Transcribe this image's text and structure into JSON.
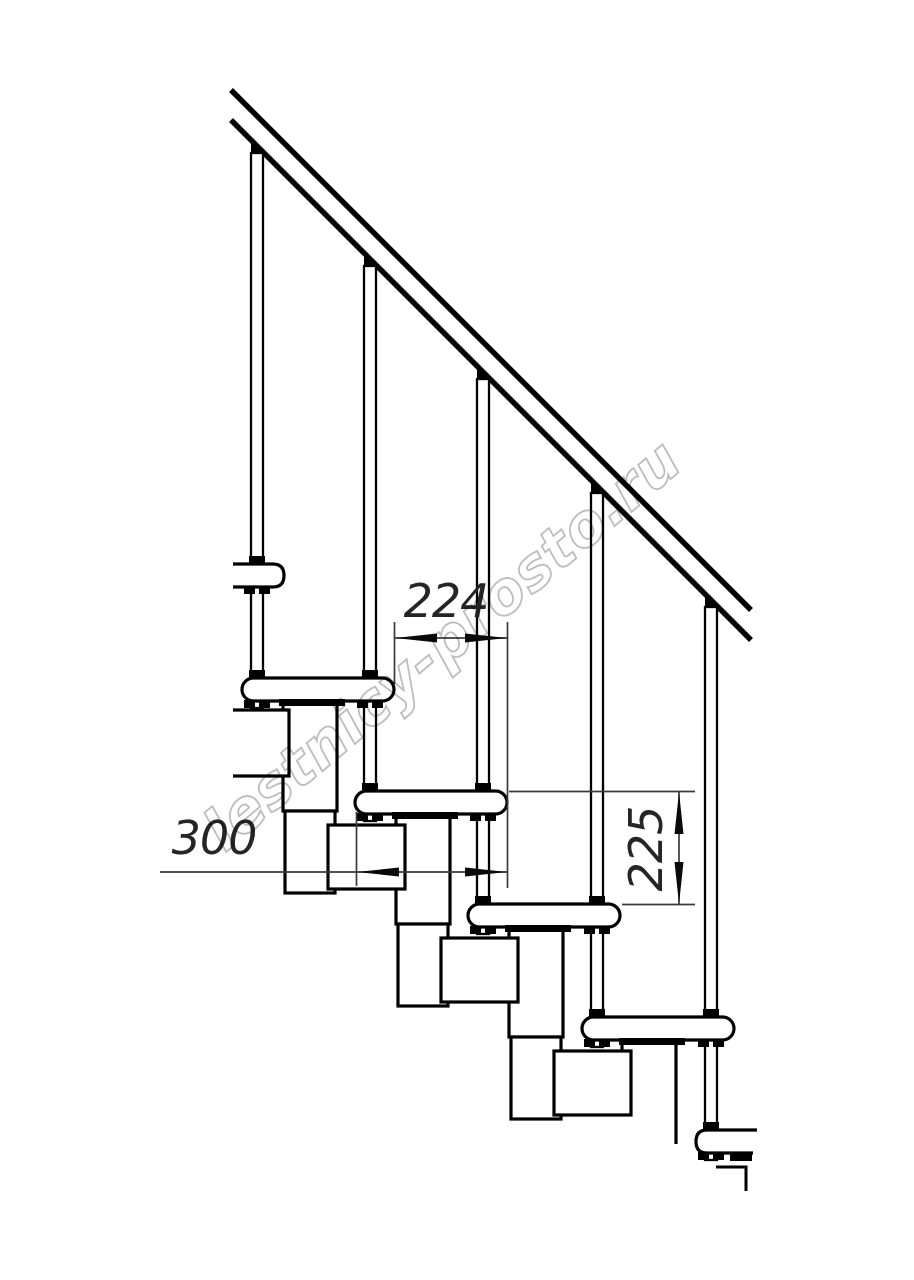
{
  "drawing": {
    "type": "technical-drawing",
    "subject": "modular staircase side elevation",
    "watermark": "lestnicy-prosto.ru",
    "dimensions": {
      "step_run": {
        "value": "224",
        "orientation": "horizontal",
        "measures": "horizontal offset between tread noses"
      },
      "tread_depth": {
        "value": "300",
        "orientation": "horizontal",
        "measures": "tread depth"
      },
      "step_rise": {
        "value": "225",
        "orientation": "vertical",
        "measures": "rise between tread tops"
      }
    },
    "colors": {
      "background": "#ffffff",
      "line": "#000000",
      "dimension": "#3a3a3a",
      "watermark": "#bdbdbd"
    }
  }
}
